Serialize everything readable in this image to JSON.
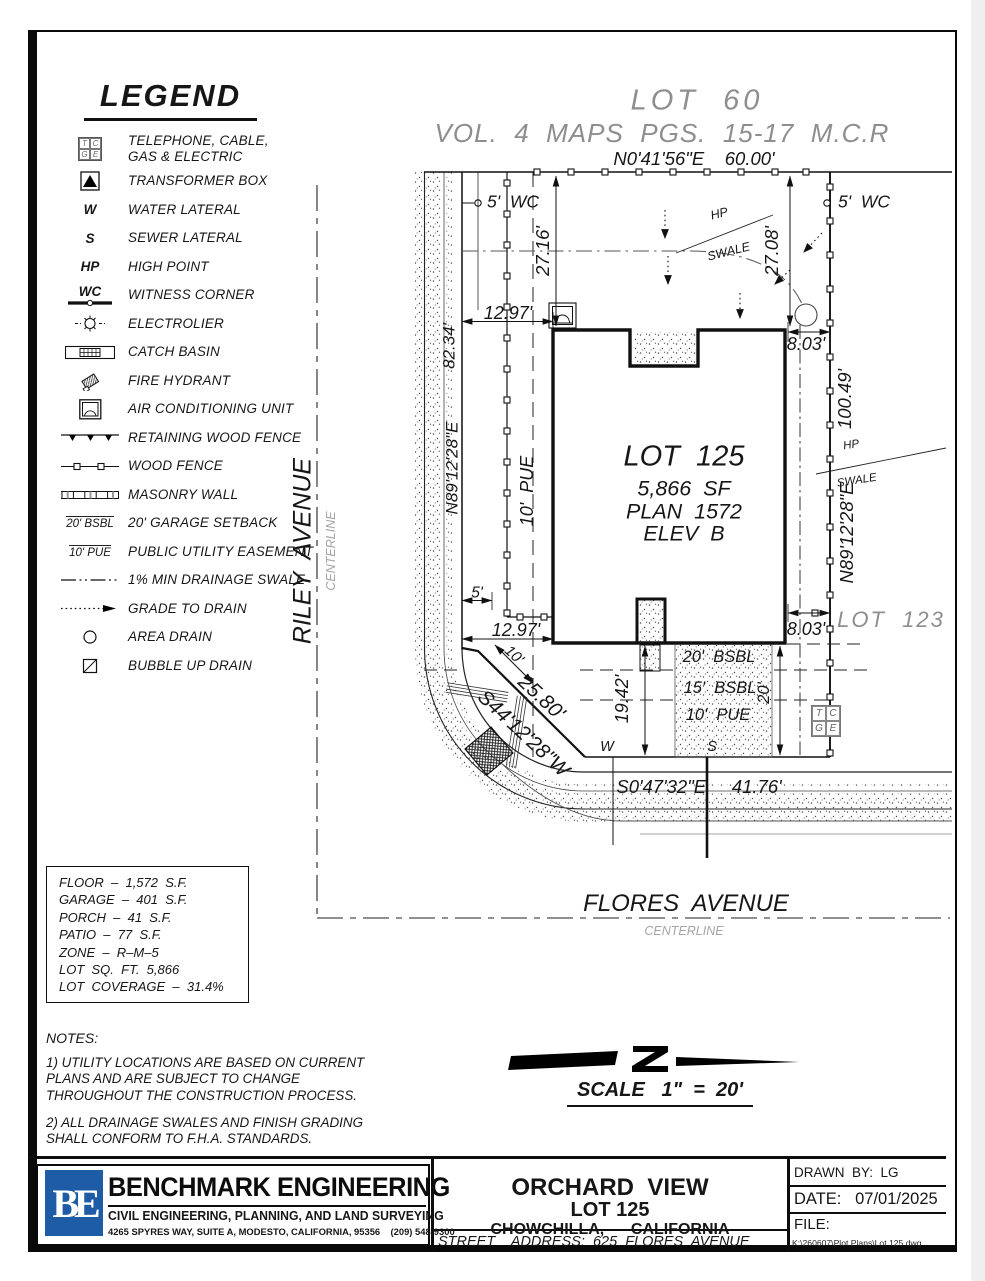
{
  "colors": {
    "line": "#111111",
    "muted": "#8e8e8e",
    "logo_blue": "#1e5da6",
    "paper": "#ffffff"
  },
  "legend": {
    "title": "LEGEND",
    "items": [
      {
        "sym": "TCGE",
        "label": "TELEPHONE, CABLE, GAS & ELECTRIC"
      },
      {
        "sym": "",
        "label": "TRANSFORMER BOX"
      },
      {
        "sym": "W",
        "label": "WATER LATERAL"
      },
      {
        "sym": "S",
        "label": "SEWER LATERAL"
      },
      {
        "sym": "HP",
        "label": "HIGH POINT"
      },
      {
        "sym": "WC",
        "label": "WITNESS CORNER"
      },
      {
        "sym": "",
        "label": "ELECTROLIER"
      },
      {
        "sym": "",
        "label": "CATCH BASIN"
      },
      {
        "sym": "",
        "label": "FIRE HYDRANT"
      },
      {
        "sym": "",
        "label": "AIR CONDITIONING UNIT"
      },
      {
        "sym": "",
        "label": "RETAINING WOOD FENCE"
      },
      {
        "sym": "",
        "label": "WOOD FENCE"
      },
      {
        "sym": "",
        "label": "MASONRY WALL"
      },
      {
        "sym": "20' BSBL",
        "label": "20' GARAGE SETBACK"
      },
      {
        "sym": "10' PUE",
        "label": "PUBLIC UTILITY EASEMENT"
      },
      {
        "sym": "",
        "label": "1% MIN DRAINAGE SWALE"
      },
      {
        "sym": "",
        "label": "GRADE TO DRAIN"
      },
      {
        "sym": "",
        "label": "AREA DRAIN"
      },
      {
        "sym": "",
        "label": "BUBBLE UP DRAIN"
      }
    ]
  },
  "plan": {
    "lot60": "LOT  60",
    "vol": "VOL.  4  MAPS  PGS.  15-17  M.C.R",
    "north": "N0'41'56\"E    60.00'",
    "wcl": "5'  WC",
    "wcr": "5'  WC",
    "d2716": "27.16'",
    "d2708": "27.08'",
    "hp": "HP",
    "swale": "SWALE",
    "d1297t": "12.97'",
    "d803t": "8.03'",
    "wlen": "82.34'",
    "wbrg": "N89'12'28\"E",
    "puev": "10'  PUE",
    "lotname": "LOT  125",
    "lotsf": "5,866  SF",
    "lotplan": "PLAN  1572",
    "lotelev": "ELEV  B",
    "elen": "100.49'",
    "ebrg": "N89'12'28\"E",
    "lot123": "LOT  123",
    "d5": "5'",
    "d1297b": "12.97'",
    "d803b": "8.03'",
    "d10": "10'",
    "dlen": "25.80'",
    "dbrg": "S44'12'28\"W",
    "d1942": "19.42'",
    "bsbl20": "20'  BSBL",
    "bsbl15": "15'  BSBL",
    "pue10": "10'  PUE",
    "d20": "20'",
    "w": "W",
    "s": "S",
    "south": "S0'47'32\"E     41.76'",
    "riley": "RILEY  AVENUE",
    "rileysub": "CENTERLINE",
    "flores": "FLORES  AVENUE",
    "floressub": "CENTERLINE",
    "tcge": [
      "T",
      "C",
      "G",
      "E"
    ]
  },
  "stats": {
    "lines": [
      "FLOOR  –  1,572  S.F.",
      "GARAGE  –  401  S.F.",
      "PORCH  –  41  S.F.",
      "PATIO  –  77  S.F.",
      "ZONE  –  R–M–5",
      "LOT  SQ.  FT.  5,866",
      "LOT  COVERAGE  –  31.4%"
    ]
  },
  "notes": {
    "title": "NOTES:",
    "n1": "1)  UTILITY  LOCATIONS  ARE  BASED  ON  CURRENT  PLANS AND  ARE  SUBJECT  TO  CHANGE  THROUGHOUT  THE CONSTRUCTION  PROCESS.",
    "n2": "2)  ALL  DRAINAGE  SWALES  AND  FINISH  GRADING  SHALL CONFORM  TO  F.H.A.  STANDARDS."
  },
  "scale": {
    "label": "SCALE   1\"  =  20'"
  },
  "tb": {
    "logo": "BE",
    "name": "BENCHMARK ENGINEERING",
    "tagline": "CIVIL ENGINEERING, PLANNING, AND LAND SURVEYING",
    "address": "4265 SPYRES WAY, SUITE A, MODESTO, CALIFORNIA, 95356    (209) 548-9300",
    "proj": "ORCHARD  VIEW",
    "lot": "LOT 125",
    "city": "CHOWCHILLA,      CALIFORNIA",
    "street": "STREET    ADDRESS:  625  FLORES  AVENUE",
    "drawn": "DRAWN  BY:  LG",
    "date": "DATE:   07/01/2025",
    "file": "FILE:",
    "path": "K:\\260607\\Plot Plans\\Lot 125.dwg"
  }
}
